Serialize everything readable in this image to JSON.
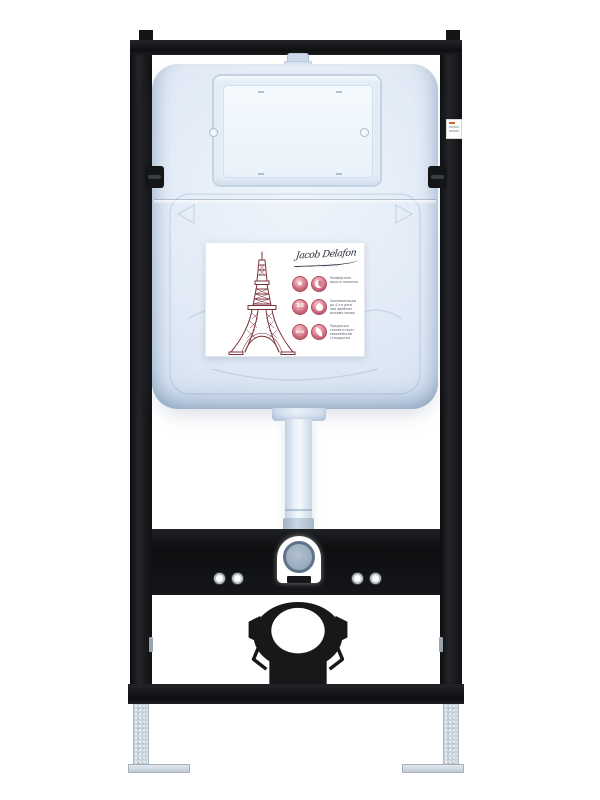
{
  "photo": {
    "subject": "wall-hung toilet concealed cistern installation frame, front view, white background"
  },
  "brand": {
    "signature": "Jacob Delafon",
    "city": "PARIS"
  },
  "label": {
    "badge_10": "10",
    "badge_eco": "eco",
    "features": [
      {
        "text": "Комфортная высота нажатия"
      },
      {
        "text": "Экономия воды до 4 л в день при двойном режиме смыва"
      },
      {
        "text": "Продукция соответствует европейским стандартам"
      }
    ]
  },
  "colors": {
    "frame_black": "#141517",
    "cistern_blue": "#dfe9f5",
    "accent_pink": "#c65b70",
    "tower_maroon": "#7b3039",
    "fitting_blue_gray": "#8ba0b5",
    "feet_galvanized": "#ccd6de"
  }
}
